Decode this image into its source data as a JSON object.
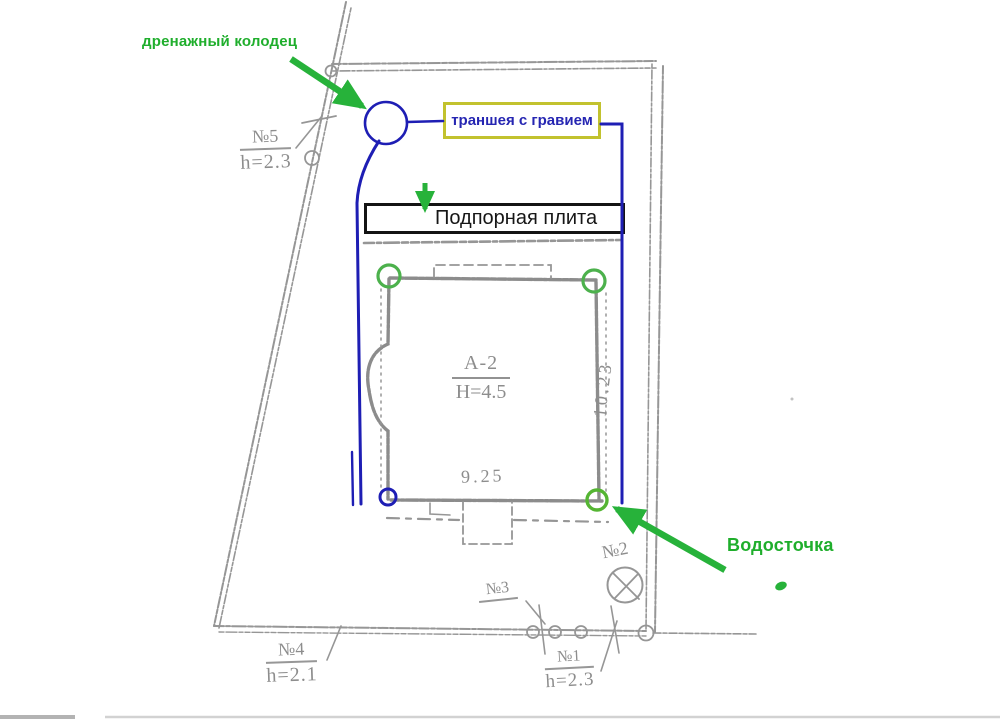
{
  "callouts": {
    "drainage_well": "дренажный колодец",
    "gravel_trench": "траншея с гравием",
    "retaining_plate": "Подпорная плита",
    "downspout": "Водосточка"
  },
  "survey_points": {
    "p5": {
      "no": "№5",
      "h": "h=2.3"
    },
    "p4": {
      "no": "№4",
      "h": "h=2.1"
    },
    "p3": {
      "no": "№3"
    },
    "p2": {
      "no": "№2"
    },
    "p1": {
      "no": "№1",
      "h": "h=2.3"
    }
  },
  "building": {
    "name": "А-2",
    "height": "Н=4.5",
    "width_dim": "9.25",
    "depth_dim": "10.23"
  },
  "colors": {
    "trench_blue": "#1e1eb4",
    "annotation_green": "#1fae2c",
    "ring_green": "#4cb14c",
    "box_yellow": "#c2c22e",
    "scan_gray": "#969696"
  }
}
